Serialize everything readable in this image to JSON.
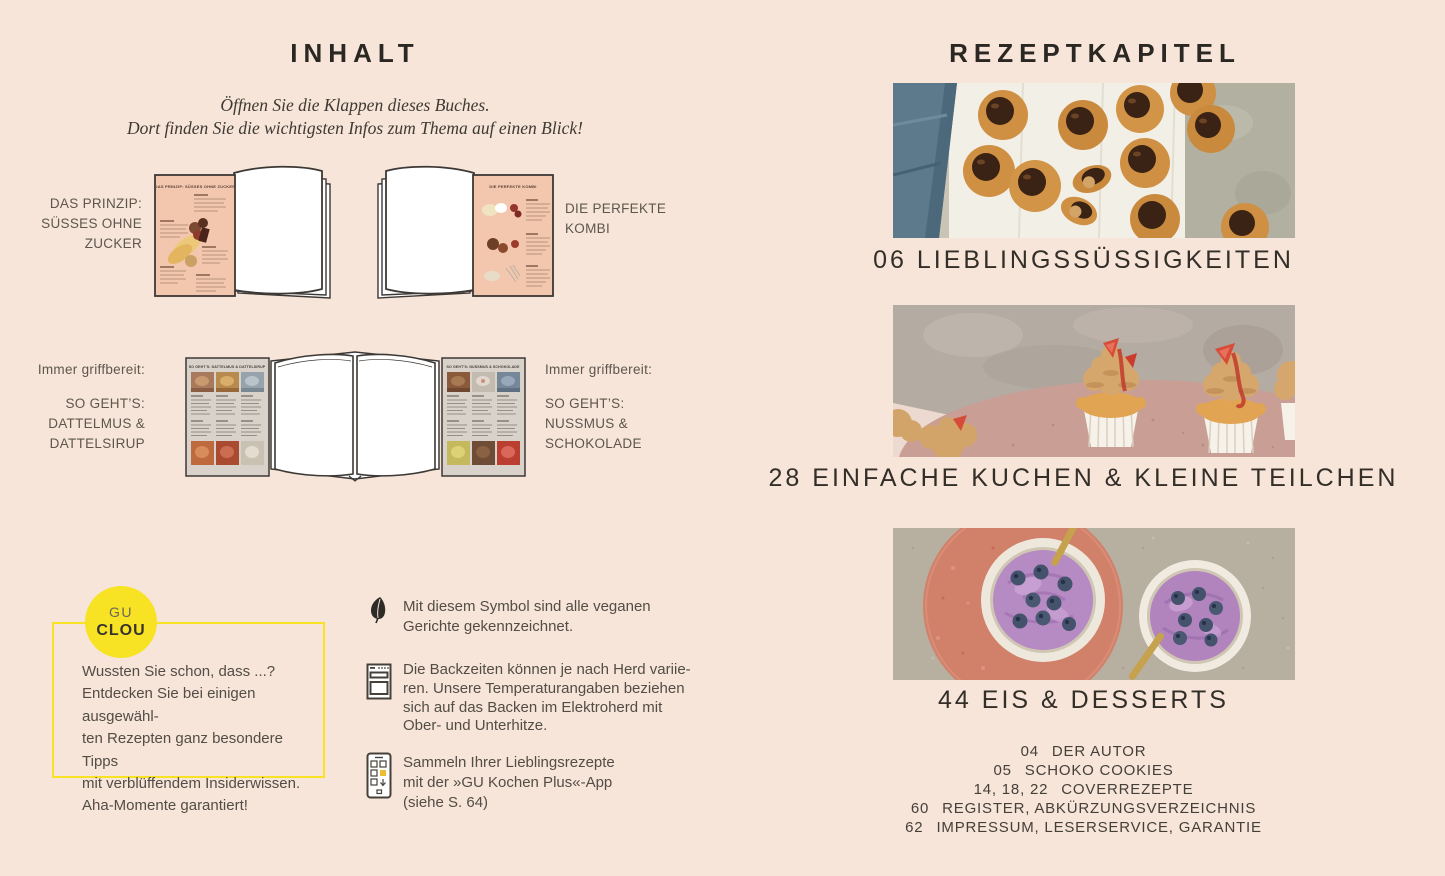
{
  "colors": {
    "background": "#f6e5d8",
    "accent_yellow": "#f7e324",
    "heading_dark": "#2b2723",
    "body_text": "#534d46",
    "flap_pink": "#f3c6ae",
    "flap_gray": "#d8d2ca"
  },
  "left_page": {
    "title": "INHALT",
    "intro": {
      "line1": "Öffnen Sie die Klappen dieses Buches.",
      "line2": "Dort finden Sie die wichtigsten Infos zum Thema auf einen Blick!"
    },
    "row1": {
      "left_label": {
        "line1": "DAS PRINZIP:",
        "line2": "SÜSSES OHNE",
        "line3": "ZUCKER"
      },
      "left_flap_title": "DAS PRINZIP: SÜSSES OHNE ZUCKER",
      "right_label": {
        "line1": "DIE PERFEKTE",
        "line2": "KOMBI"
      },
      "right_flap_title": "DIE PERFEKTE KOMBI"
    },
    "row2": {
      "left_label": {
        "intro": "Immer griffbereit:",
        "line1": "SO GEHT’S:",
        "line2": "DATTELMUS &",
        "line3": "DATTELSIRUP"
      },
      "left_flap_title": "SO GEHT’S: DATTELMUS & DATTELSIRUP",
      "right_label": {
        "intro": "Immer griffbereit:",
        "line1": "SO GEHT’S:",
        "line2": "NUSSMUS &",
        "line3": "SCHOKOLADE"
      },
      "right_flap_title": "SO GEHT’S: NUSSMUS & SCHOKOLADE"
    },
    "clou": {
      "badge_top": "GU",
      "badge_bottom": "CLOU",
      "line1": "Wussten Sie schon, dass ...?",
      "line2": "Entdecken Sie bei einigen ausgewähl-",
      "line3": "ten Rezepten ganz besondere Tipps",
      "line4": "mit verblüffendem Insiderwissen.",
      "line5": "Aha-Momente garantiert!"
    },
    "notes": {
      "vegan": {
        "icon": "leaf-icon",
        "line1": "Mit diesem Symbol sind alle veganen",
        "line2": "Gerichte gekennzeichnet."
      },
      "oven": {
        "icon": "oven-icon",
        "line1": "Die Backzeiten können je nach Herd variie-",
        "line2": "ren. Unsere Temperaturangaben beziehen",
        "line3": "sich auf das Backen im Elektroherd mit",
        "line4": "Ober- und Unterhitze."
      },
      "app": {
        "icon": "smartphone-icon",
        "line1": "Sammeln Ihrer Lieblingsrezepte",
        "line2": "mit der »GU Kochen Plus«-App",
        "line3": "(siehe S. 64)"
      }
    }
  },
  "right_page": {
    "title": "REZEPTKAPITEL",
    "chapters": [
      {
        "heading": "06 LIEBLINGSSÜSSIGKEITEN",
        "photo": "caramel-candies-with-chocolate-tops"
      },
      {
        "heading": "28 EINFACHE KUCHEN & KLEINE TEILCHEN",
        "photo": "cupcakes-with-frosting-and-strawberries"
      },
      {
        "heading": "44 EIS & DESSERTS",
        "photo": "blueberry-ice-cream-bowls"
      }
    ],
    "index": [
      {
        "pages": "04",
        "label": "DER AUTOR"
      },
      {
        "pages": "05",
        "label": "SCHOKO COOKIES"
      },
      {
        "pages": "14, 18, 22",
        "label": "COVERREZEPTE"
      },
      {
        "pages": "60",
        "label": "REGISTER, ABKÜRZUNGSVERZEICHNIS"
      },
      {
        "pages": "62",
        "label": "IMPRESSUM, LESERSERVICE, GARANTIE"
      }
    ]
  }
}
